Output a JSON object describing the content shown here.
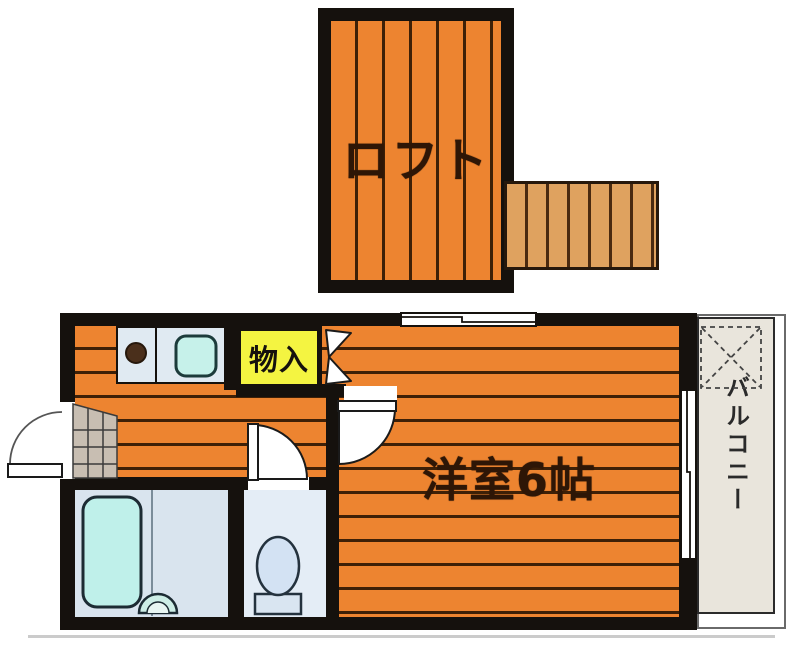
{
  "plan_type": "apartment-floor-plan",
  "labels": {
    "loft": "ロフト",
    "main_room": "洋室6帖",
    "closet": "物入",
    "balcony": "バルコニー"
  },
  "colors": {
    "flooring_orange": "#ED8430",
    "floor_stripe_line": "#3E2007",
    "ladder_wood": "#DFA25F",
    "closet_yellow": "#F4F441",
    "wall_black": "#15110D",
    "counter_top": "#E0EAF2",
    "fixture_cyan": "#C6F1EA",
    "bath_floor": "#D9E4EE",
    "toilet_floor": "#E4EDF6",
    "genkan_tile": "#C8BEB2",
    "balcony_beige": "#E9E5DC",
    "label_brown": "#2E1606"
  },
  "fixtures": [
    "gas-burner",
    "kitchen-sink",
    "storage-bifold-door",
    "entrance-door",
    "room-door",
    "toilet-door",
    "bathtub",
    "wash-basin",
    "toilet",
    "loft-ladder",
    "sliding-window-top",
    "sliding-window-balcony",
    "balcony-hatch-mark",
    "genkan-tile-area"
  ]
}
